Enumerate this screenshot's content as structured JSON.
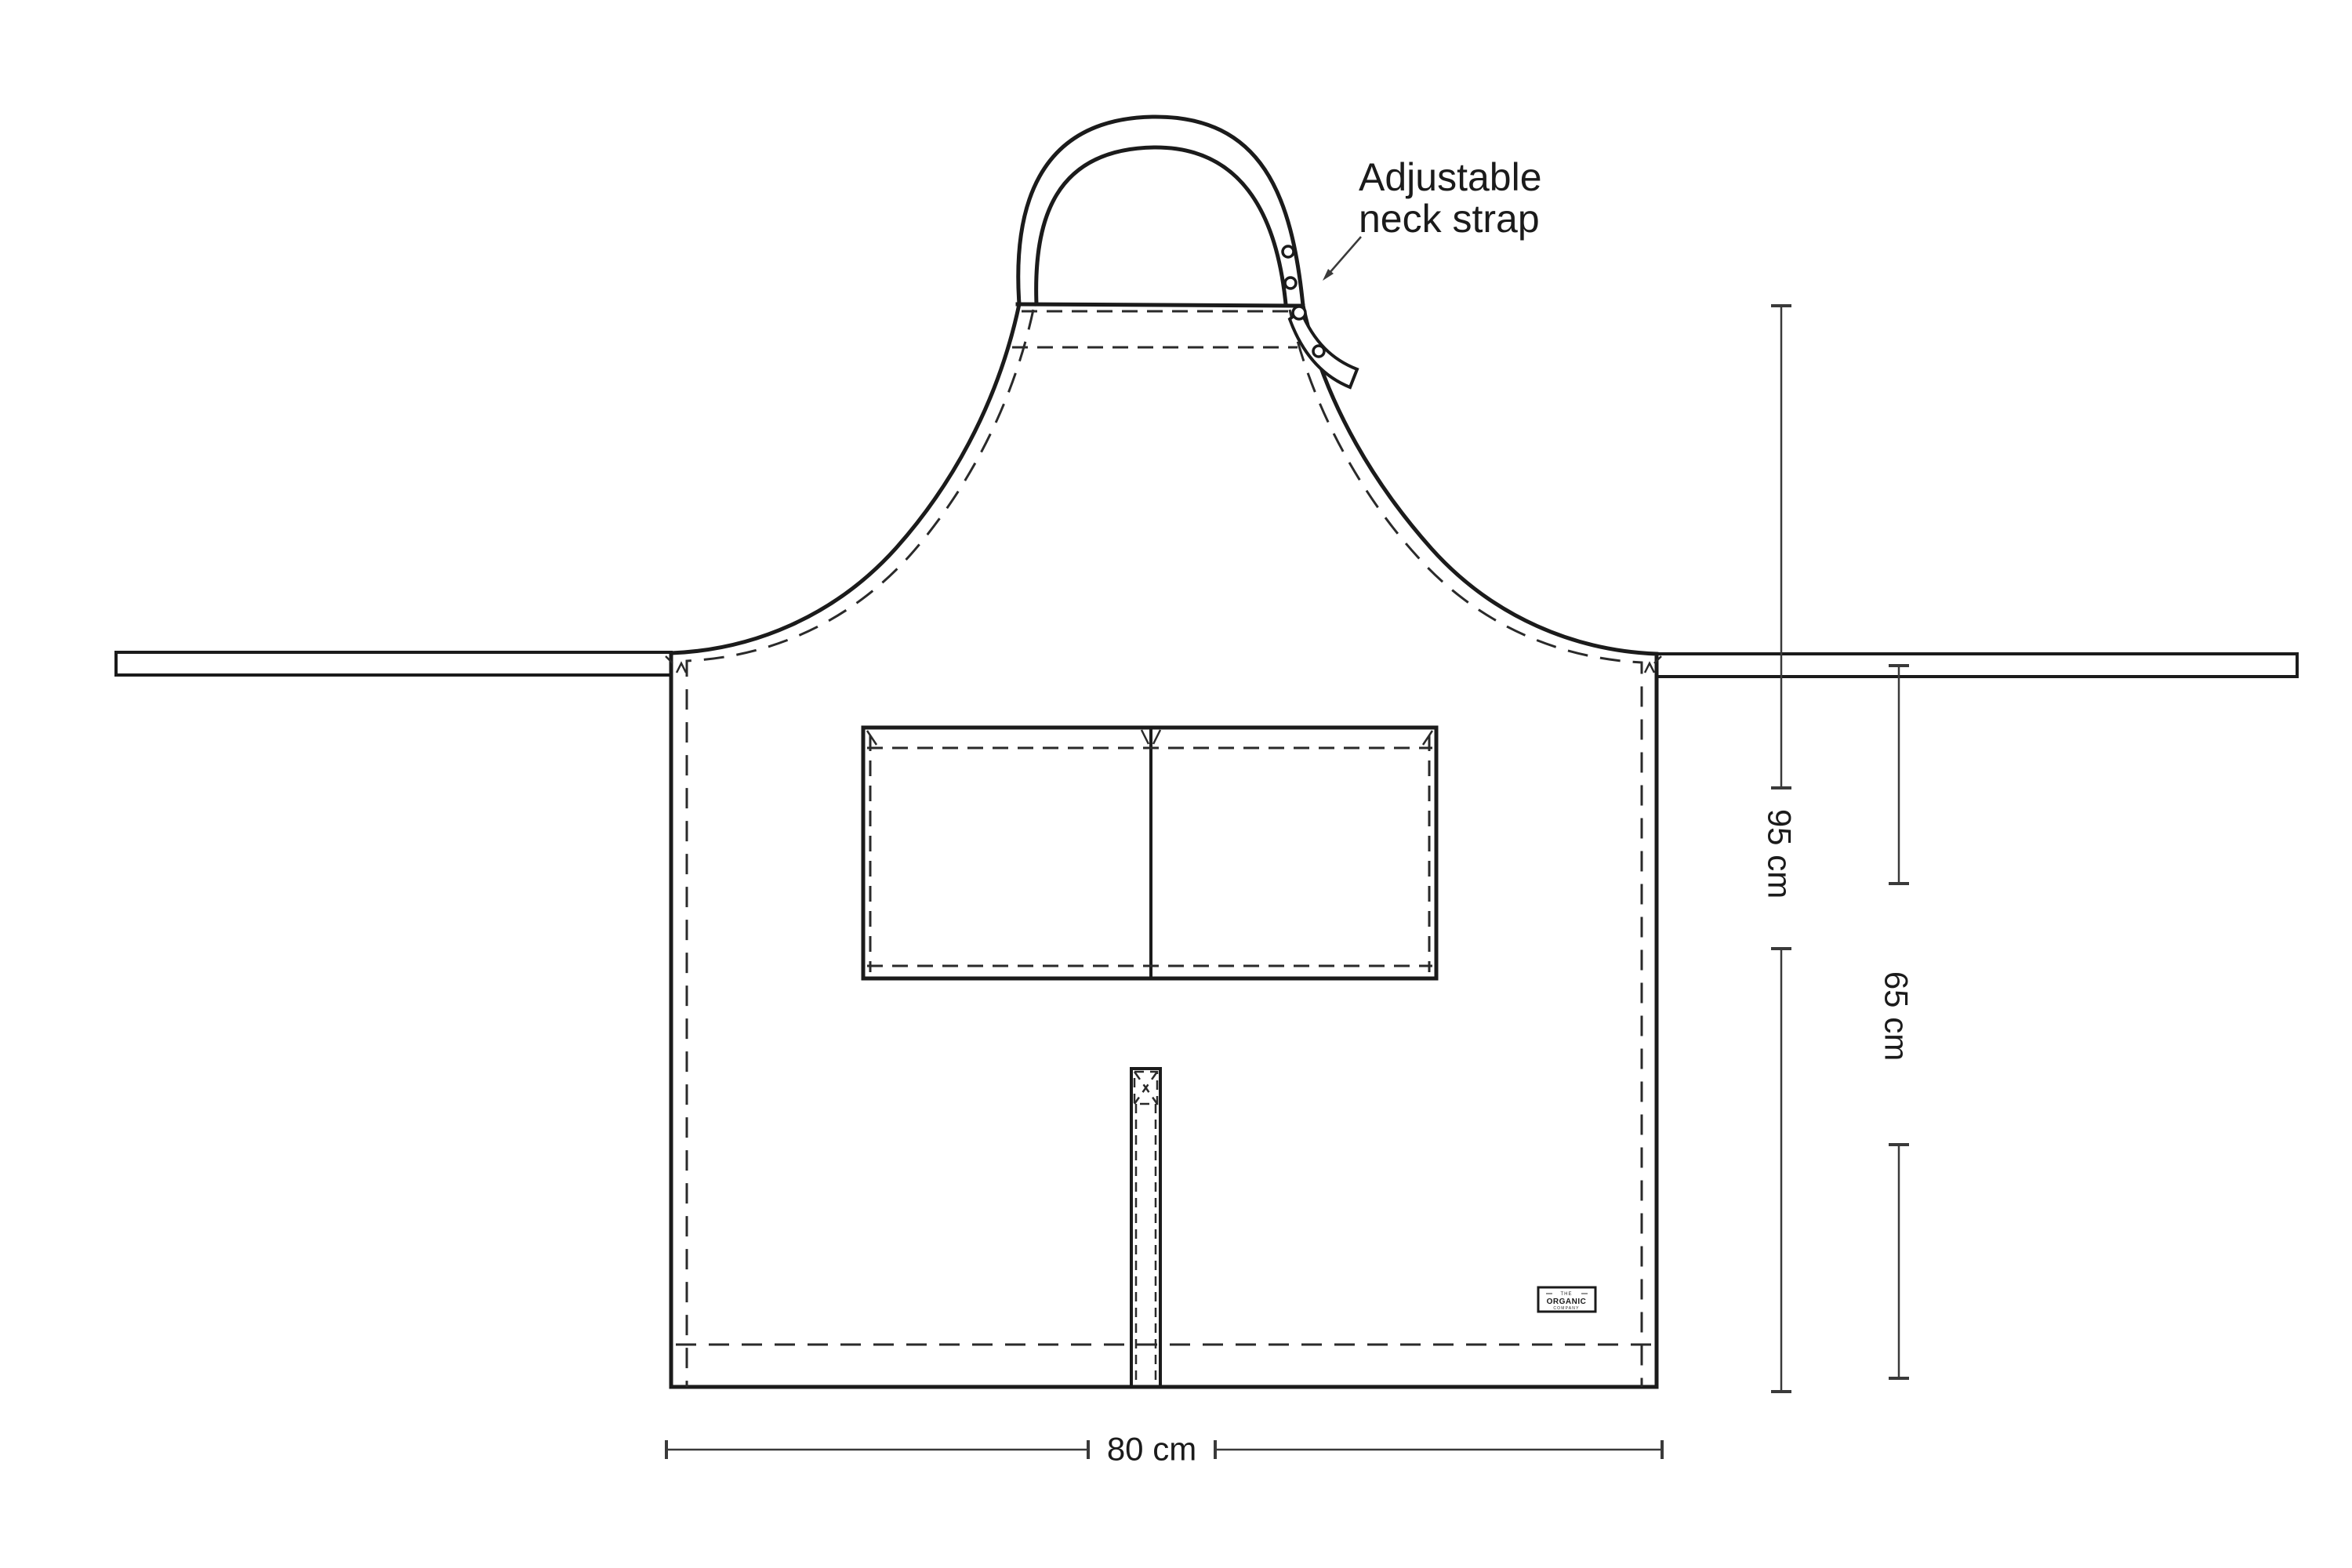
{
  "annotation": {
    "line1": "Adjustable",
    "line2": "neck strap"
  },
  "dimensions": {
    "total_height": "95 cm",
    "skirt_height": "65 cm",
    "width": "80 cm"
  },
  "brand_label": {
    "line1": "THE",
    "line2": "ORGANIC",
    "line3": "COMPANY"
  },
  "colors": {
    "ink": "#1b1b1b",
    "stitch": "#2a2a2a",
    "dimension": "#3a3a3a",
    "background": "#ffffff"
  }
}
